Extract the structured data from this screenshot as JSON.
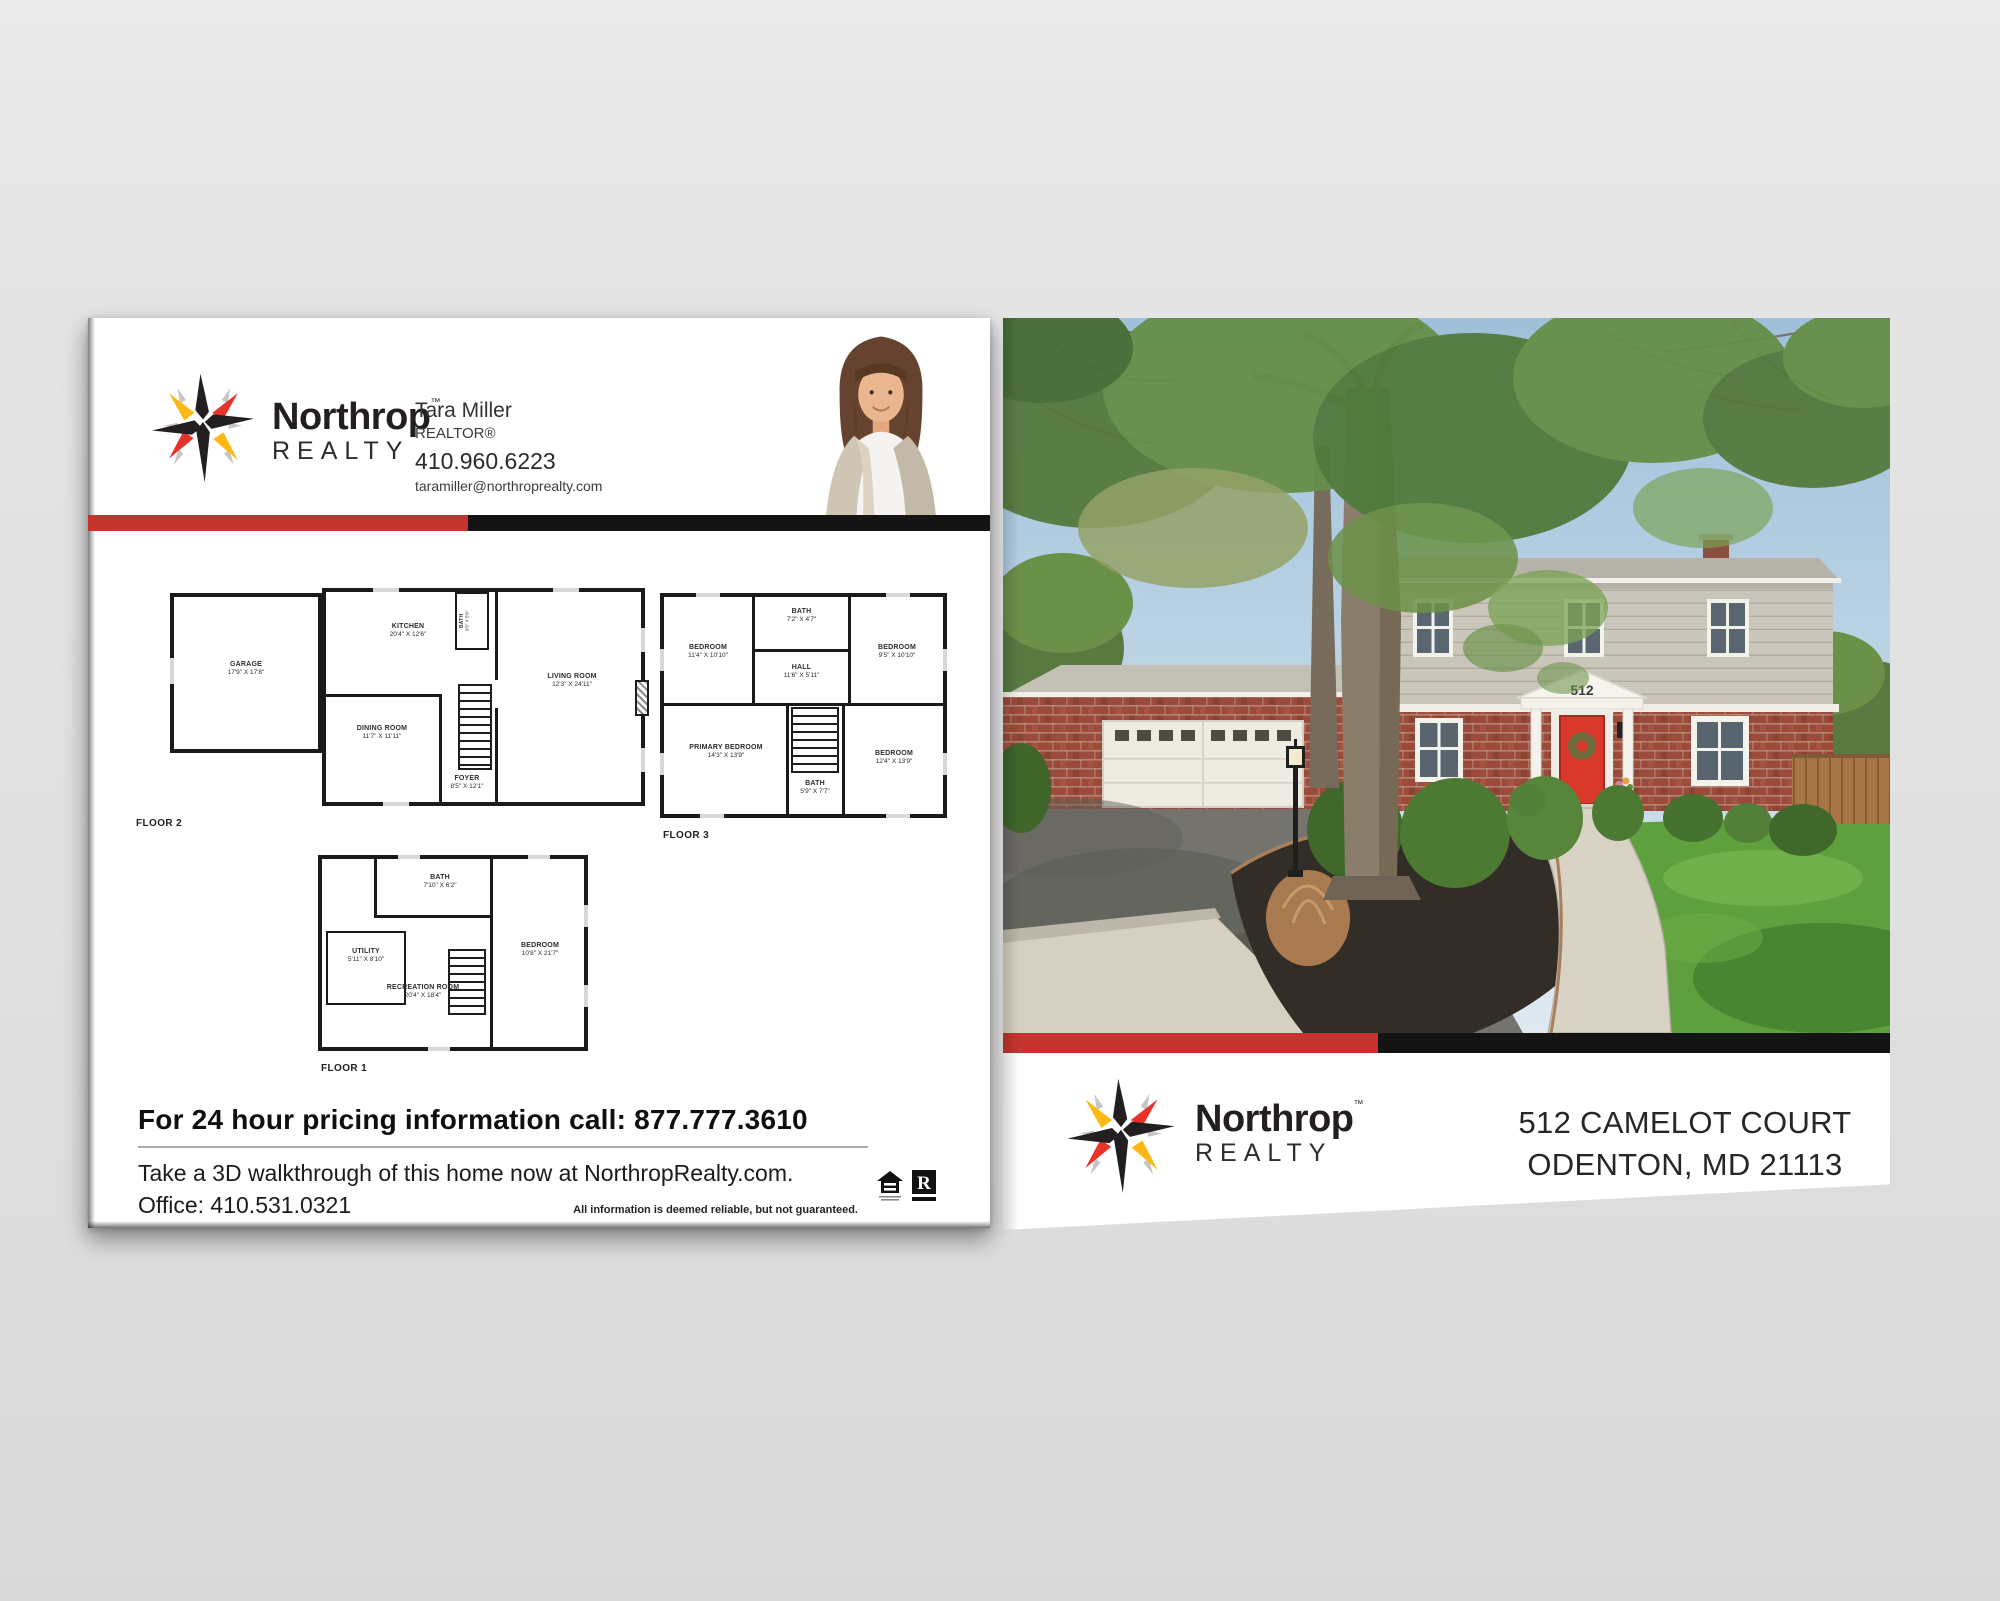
{
  "brand": {
    "name": "Northrop",
    "tm": "™",
    "subname": "REALTY"
  },
  "agent": {
    "name": "Tara Miller",
    "title": "REALTOR®",
    "phone": "410.960.6223",
    "email": "taramiller@northroprealty.com"
  },
  "floors": [
    {
      "name": "FLOOR 2",
      "rooms": [
        {
          "label": "GARAGE",
          "dims": "17'9\" X 17'8\""
        },
        {
          "label": "KITCHEN",
          "dims": "20'4\" X 12'6\""
        },
        {
          "label": "DINING ROOM",
          "dims": "11'7\" X 11'11\""
        },
        {
          "label": "FOYER",
          "dims": "8'5\" X 12'1\""
        },
        {
          "label": "LIVING ROOM",
          "dims": "12'3\" X 24'11\""
        },
        {
          "label": "BATH",
          "dims": "9'5\" X 5'6\""
        }
      ]
    },
    {
      "name": "FLOOR 3",
      "rooms": [
        {
          "label": "BEDROOM",
          "dims": "11'4\" X 10'10\""
        },
        {
          "label": "BATH",
          "dims": "7'2\" X 4'7\""
        },
        {
          "label": "HALL",
          "dims": "11'6\" X 5'11\""
        },
        {
          "label": "BEDROOM",
          "dims": "9'5\" X 10'10\""
        },
        {
          "label": "PRIMARY BEDROOM",
          "dims": "14'3\" X 13'9\""
        },
        {
          "label": "BATH",
          "dims": "5'9\" X 7'7\""
        },
        {
          "label": "BEDROOM",
          "dims": "12'4\" X 13'9\""
        }
      ]
    },
    {
      "name": "FLOOR 1",
      "rooms": [
        {
          "label": "BATH",
          "dims": "7'10\" X 6'2\""
        },
        {
          "label": "UTILITY",
          "dims": "5'11\" X 8'10\""
        },
        {
          "label": "RECREATION ROOM",
          "dims": "20'4\" X 18'4\""
        },
        {
          "label": "BEDROOM",
          "dims": "10'8\" X 21'7\""
        }
      ]
    }
  ],
  "pricing": {
    "headline": "For 24 hour pricing information call: 877.777.3610",
    "walkthrough": "Take a 3D walkthrough of this home now at NorthropRealty.com.",
    "office": "Office: 410.531.0321",
    "disclaimer": "All information is deemed reliable, but not guaranteed."
  },
  "badges": {
    "realtor_letter": "R"
  },
  "property": {
    "house_number": "512",
    "address_line1": "512 CAMELOT COURT",
    "address_line2": "ODENTON, MD 21113"
  },
  "colors": {
    "accent_red": "#c5342f",
    "accent_black": "#141414",
    "logo_yellow": "#fdb913",
    "logo_red": "#e8332a",
    "logo_black": "#231f20",
    "door_red": "#d8392b"
  }
}
